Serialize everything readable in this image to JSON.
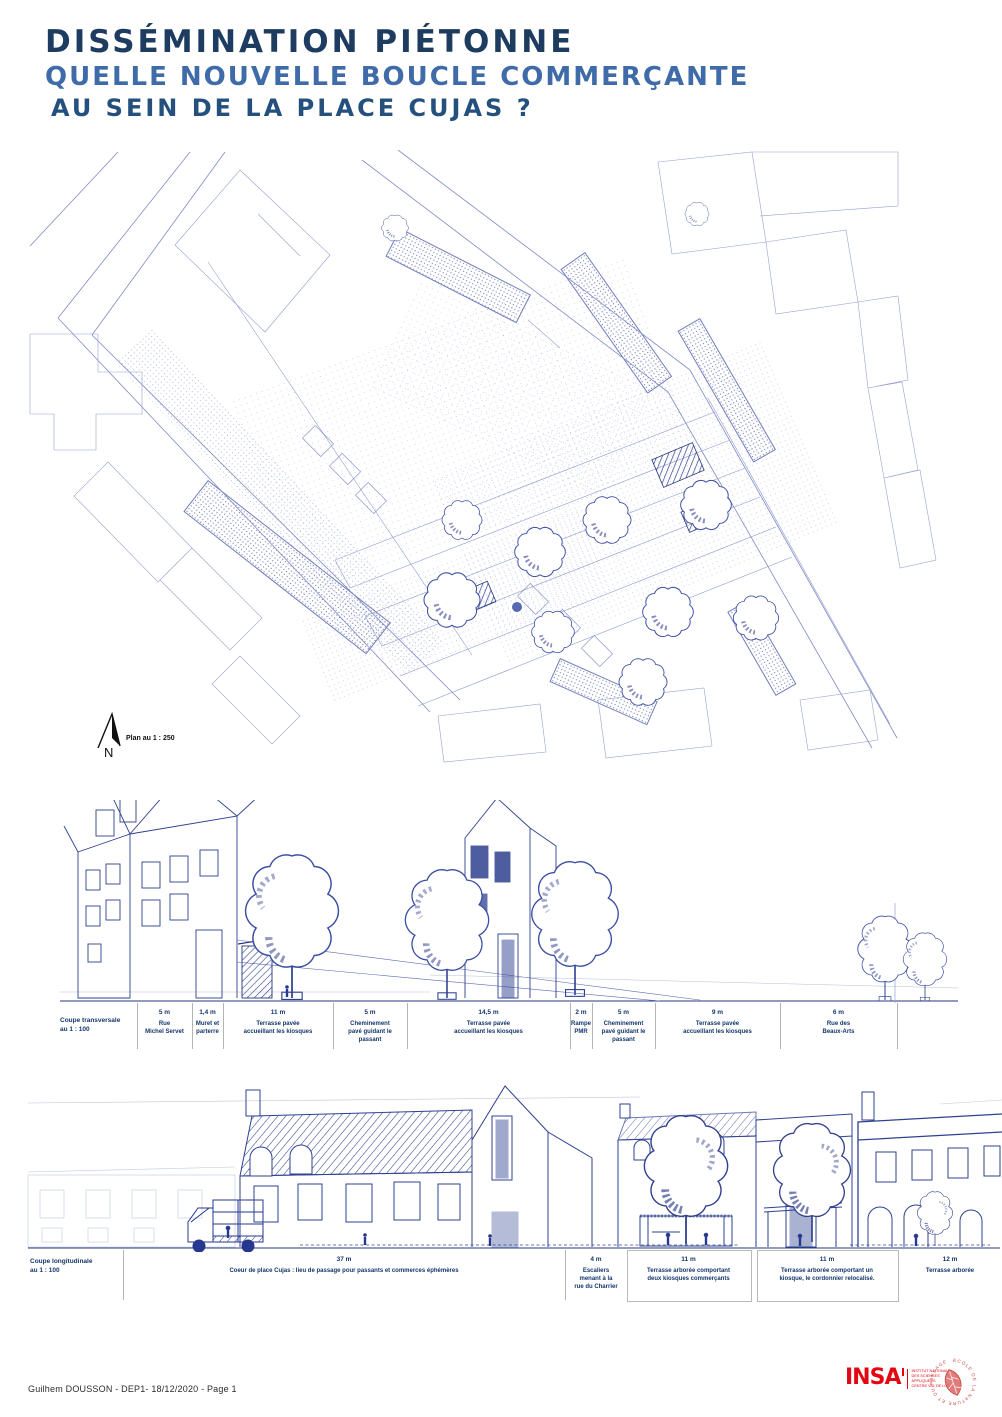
{
  "header": {
    "title_line1": "DISSÉMINATION PIÉTONNE",
    "title_line2": "QUELLE NOUVELLE BOUCLE COMMERÇANTE",
    "title_line3": "AU SEIN DE LA PLACE CUJAS ?"
  },
  "plan": {
    "north_label": "N",
    "scale_label": "Plan au 1 : 250"
  },
  "cross_section": {
    "caption": "Coupe transversale\nau 1 : 100",
    "columns": [
      {
        "value": "5 m",
        "label": "Rue\nMichel Servet"
      },
      {
        "value": "1,4 m",
        "label": "Muret et\nparterre"
      },
      {
        "value": "11 m",
        "label": "Terrasse pavée\naccueillant les kiosques"
      },
      {
        "value": "5 m",
        "label": "Cheminement\npavé guidant le\npassant"
      },
      {
        "value": "14,5 m",
        "label": "Terrasse pavée\naccueillant les kiosques"
      },
      {
        "value": "2 m",
        "label": "Rampe\nPMR"
      },
      {
        "value": "5 m",
        "label": "Cheminement\npavé guidant le\npassant"
      },
      {
        "value": "9 m",
        "label": "Terrasse pavée\naccueillant les kiosques"
      },
      {
        "value": "6 m",
        "label": "Rue des\nBeaux-Arts"
      }
    ]
  },
  "long_section": {
    "caption": "Coupe longitudinale\nau 1 : 100",
    "columns": [
      {
        "value": "37 m",
        "label": "Coeur de place Cujas : lieu de passage pour passants et commerces éphémères"
      },
      {
        "value": "4 m",
        "label": "Escaliers\nmenant à la\nrue du Charrier"
      },
      {
        "value": "11 m",
        "label": "Terrasse arborée comportant\ndeux kiosques commerçants"
      },
      {
        "value": "11 m",
        "label": "Terrasse arborée comportant un\nkiosque, le cordonnier relocalisé."
      },
      {
        "value": "12 m",
        "label": "Terrasse arborée"
      }
    ]
  },
  "footer": {
    "credit": "Guilhem DOUSSON - DEP1- 18/12/2020 - Page 1",
    "insa_acronym": "INSA",
    "insa_lines": "INSTITUT NATIONAL\nDES SCIENCES\nAPPLIQUÉES\nCENTRE VAL DE LOIRE",
    "stamp_text": "ÉCOLE DE LA NATURE ET DU PAYSAGE"
  }
}
